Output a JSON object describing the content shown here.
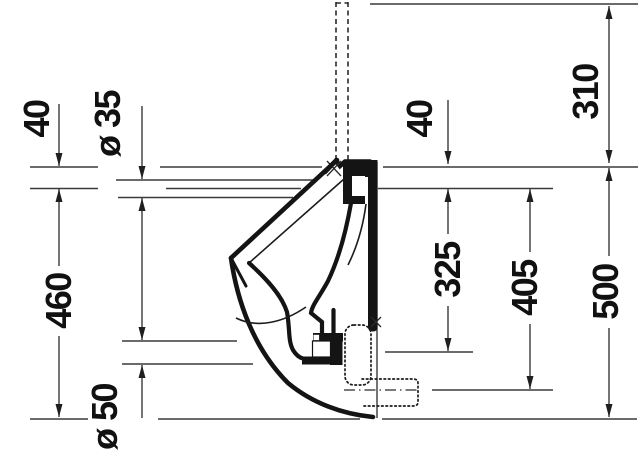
{
  "page": {
    "background": "#ffffff"
  },
  "drawing": {
    "type": "technical-section",
    "subject": "wall-mounted urinal side elevation with installation dimensions",
    "labels": {
      "offset_40_left": "40",
      "inlet_dia": "ø 35",
      "height_460": "460",
      "outlet_dia": "ø 50",
      "offset_40_right": "40",
      "height_325": "325",
      "height_405": "405",
      "height_500": "500",
      "height_310": "310"
    },
    "colors": {
      "dimension_line": "#3a3a3a",
      "body_line": "#141414",
      "label_text": "#111111",
      "background": "#ffffff"
    }
  }
}
